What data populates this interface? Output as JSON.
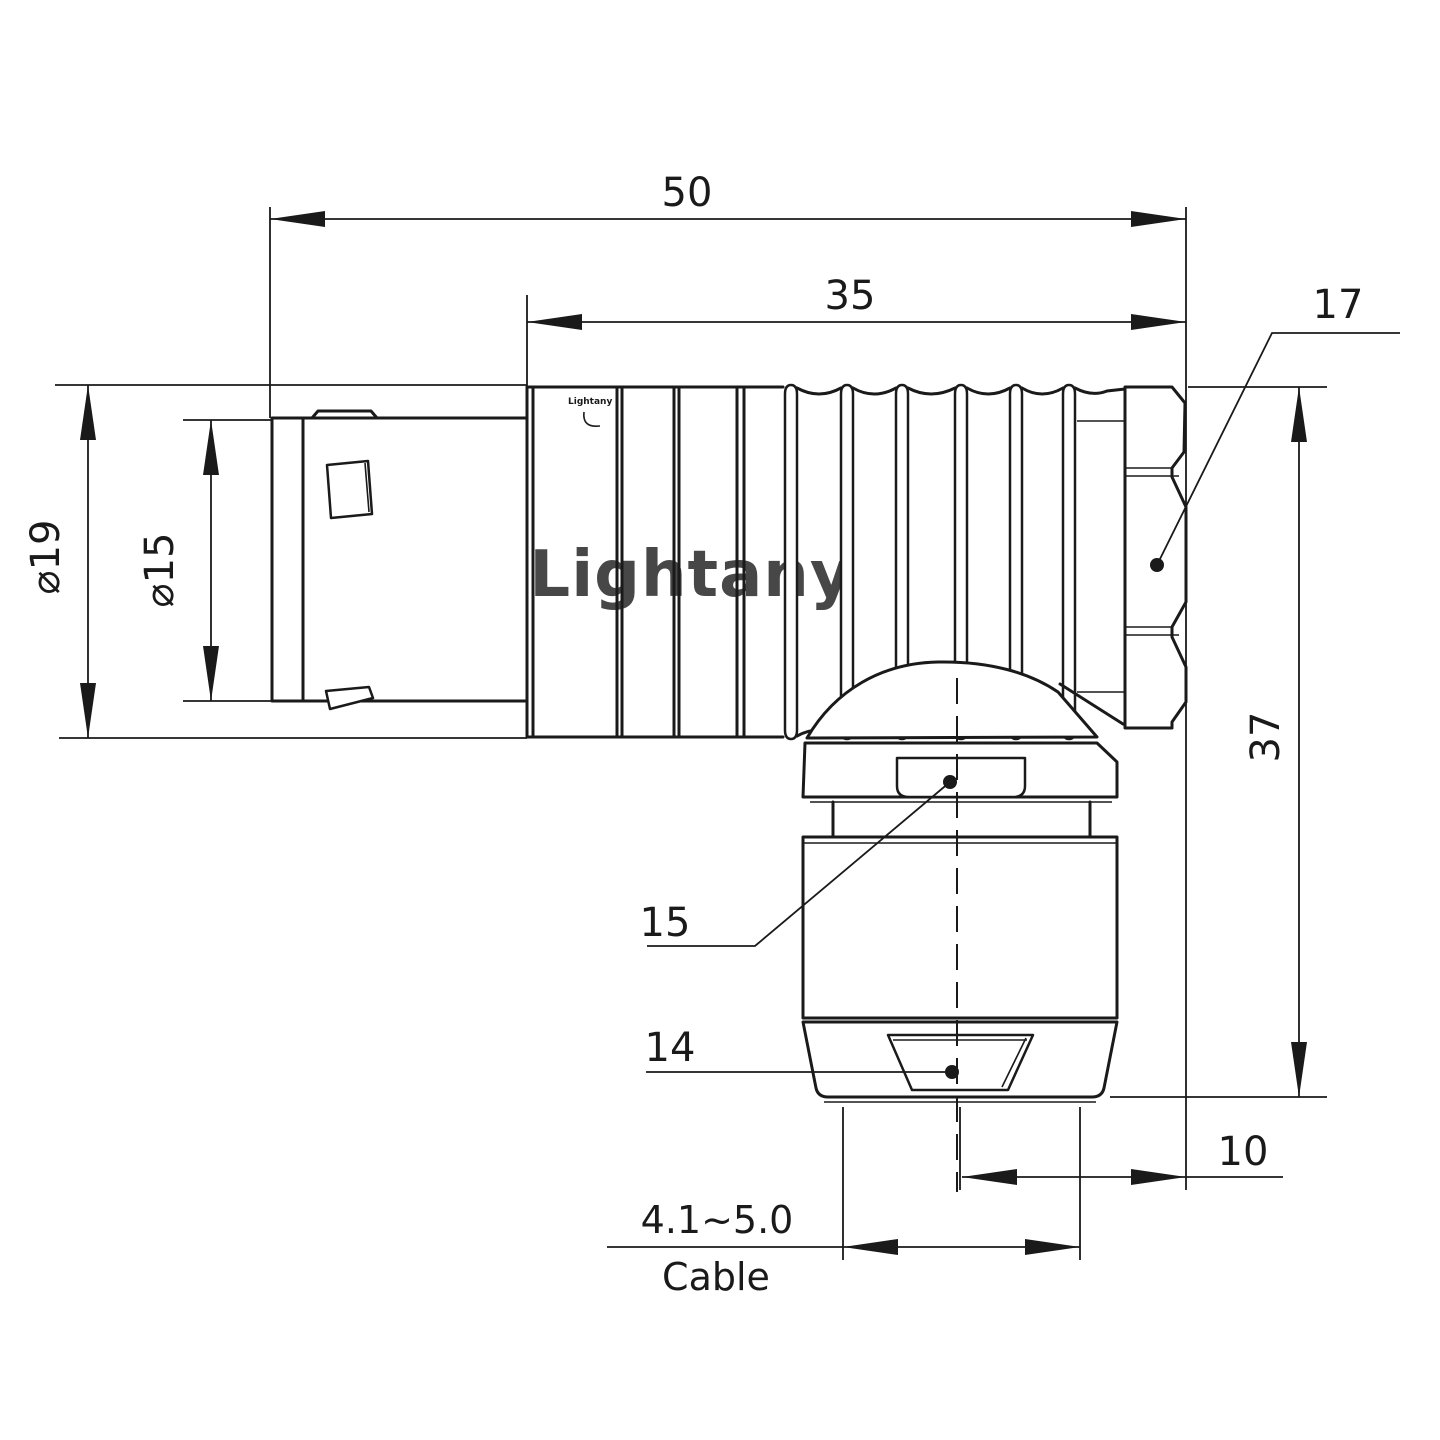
{
  "drawing": {
    "watermark": "Lightany",
    "engraving": "Lightany",
    "colors": {
      "line": "#1a1a1a",
      "watermark": "#f6c6c8",
      "background": "#ffffff"
    },
    "dims": {
      "overall_length": "50",
      "front_to_rear": "35",
      "hex_across_flats": "17",
      "outer_diameter": "⌀19",
      "mating_diameter": "⌀15",
      "total_height": "37",
      "collar_nut": "15",
      "cable_nut": "14",
      "axis_to_rear_face": "10",
      "cable_diameter_range": "4.1~5.0",
      "cable_caption": "Cable"
    }
  }
}
